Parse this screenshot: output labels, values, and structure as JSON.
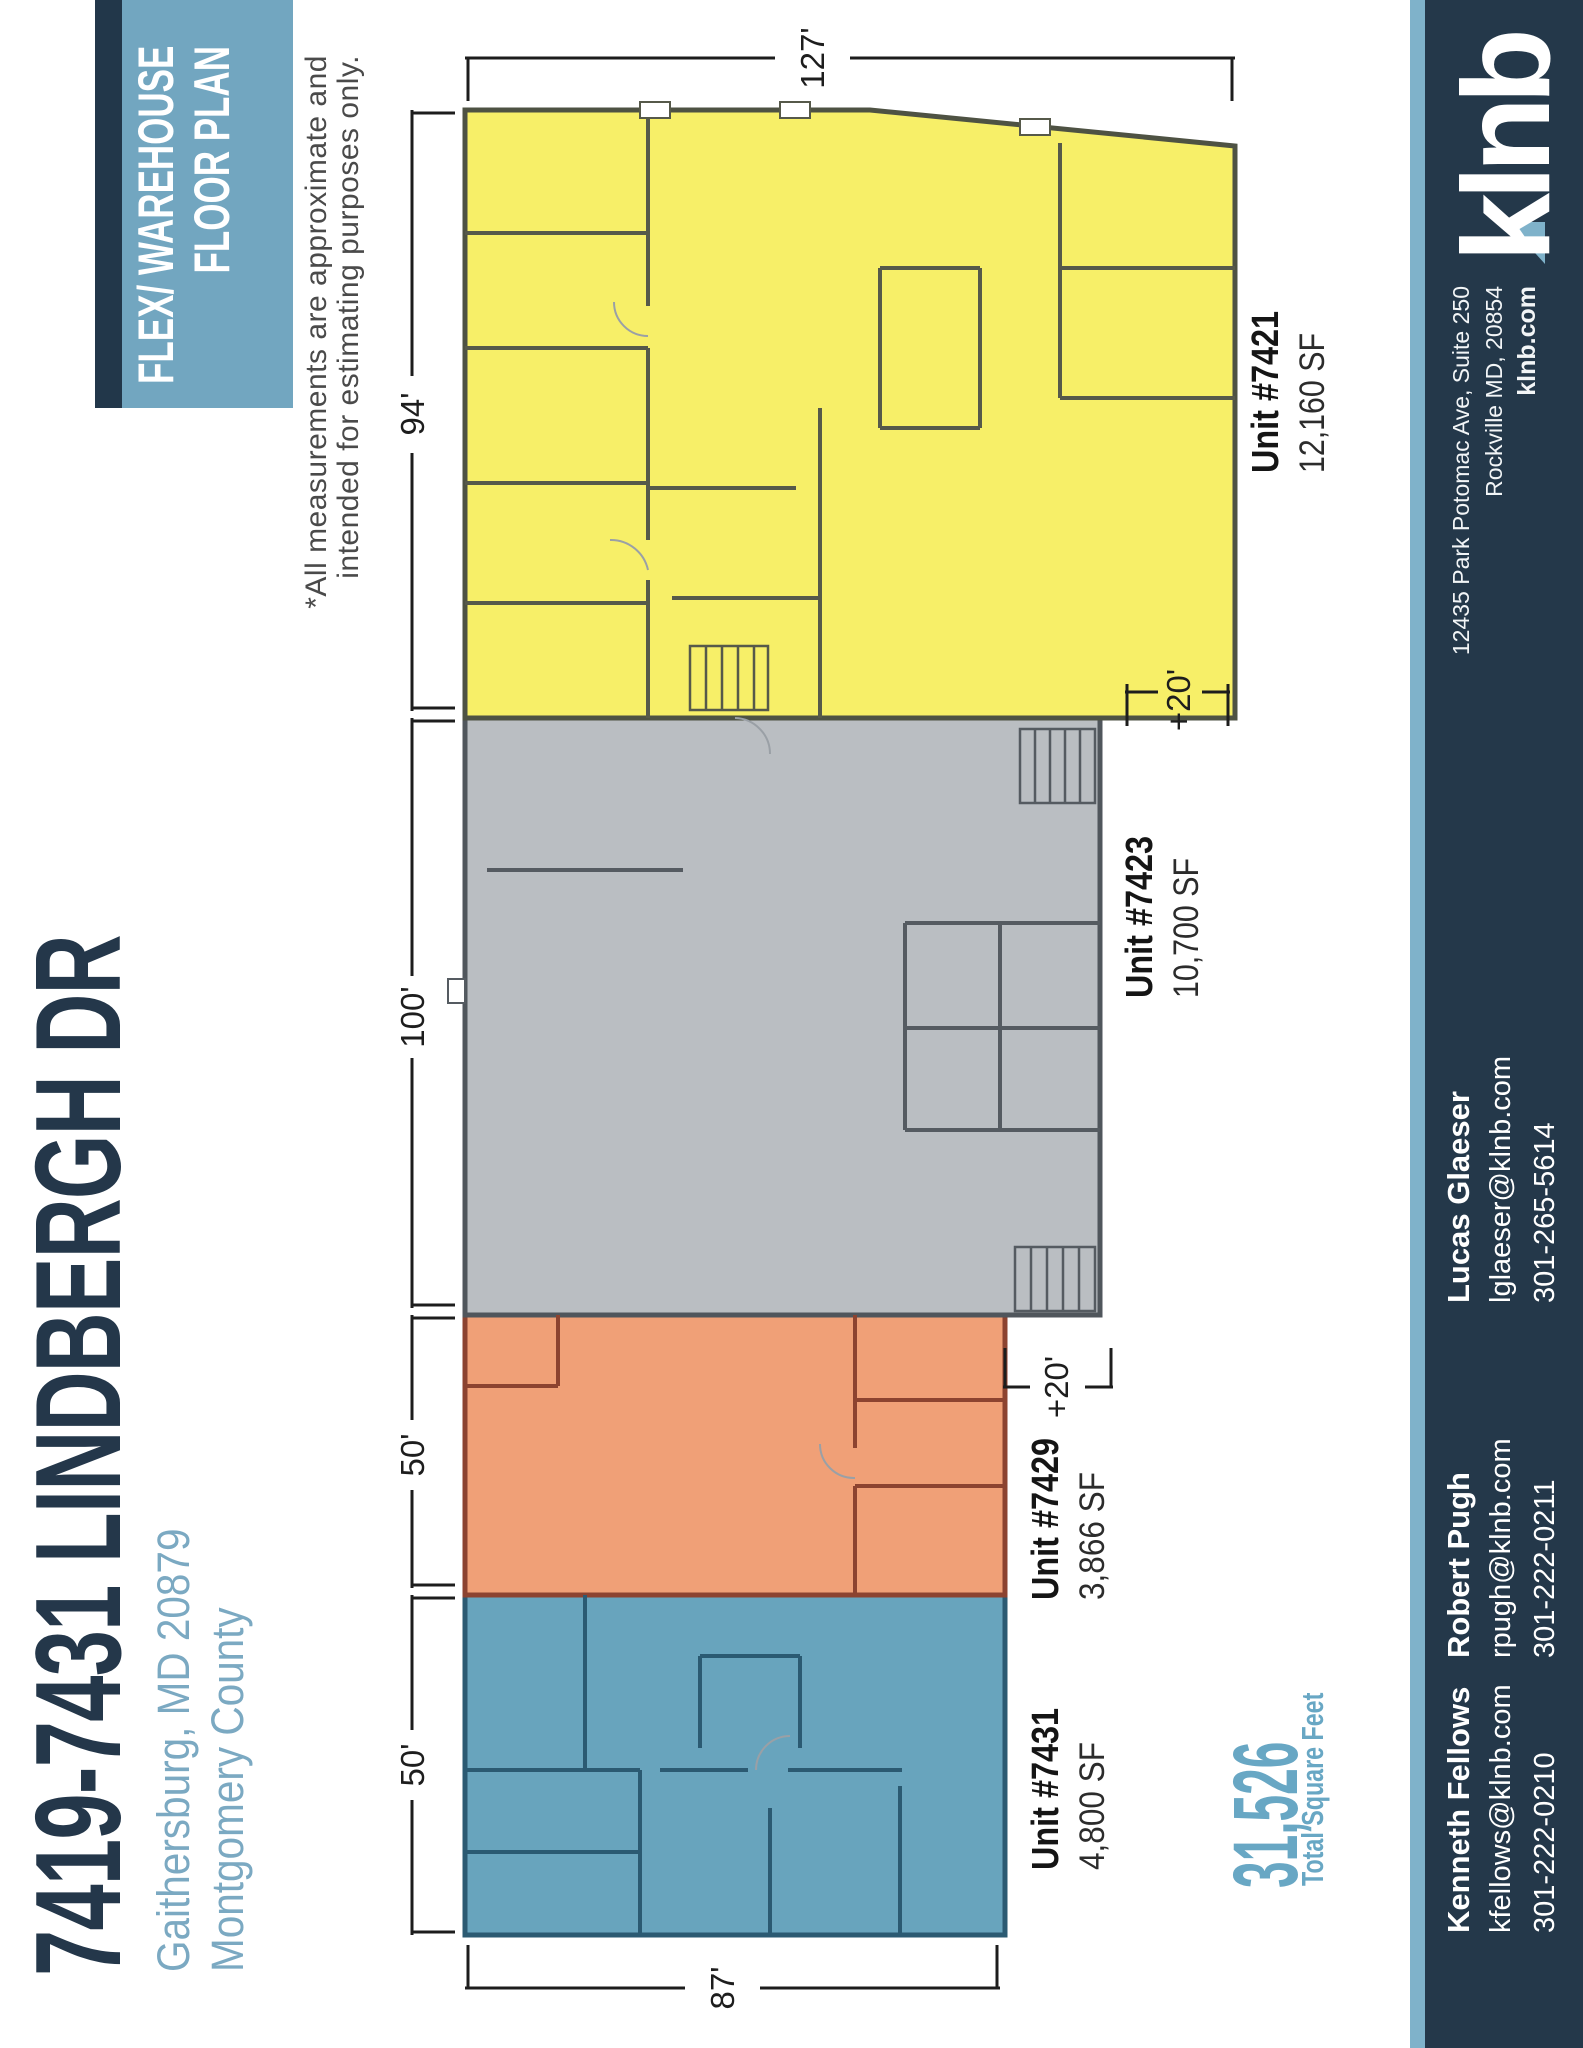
{
  "title": "7419-7431 LINDBERGH DR",
  "location": {
    "line1": "Gaithersburg, MD 20879",
    "line2": "Montgomery County"
  },
  "banner": {
    "line1": "FLEX/ WAREHOUSE",
    "line2": "FLOOR PLAN"
  },
  "disclaimer": {
    "line1": "*All measurements are approximate and",
    "line2": "intended for estimating purposes only."
  },
  "total": {
    "value": "31,526",
    "label": "Total Square Feet"
  },
  "units": [
    {
      "id": "7431",
      "name": "Unit #7431",
      "size": "4,800 SF",
      "color": "#68a4bd"
    },
    {
      "id": "7429",
      "name": "Unit #7429",
      "size": "3,866 SF",
      "color": "#f0a077"
    },
    {
      "id": "7423",
      "name": "Unit #7423",
      "size": "10,700 SF",
      "color": "#babec2"
    },
    {
      "id": "7421",
      "name": "Unit #7421",
      "size": "12,160 SF",
      "color": "#f7ef68"
    }
  ],
  "dimensions": {
    "top": [
      "50'",
      "50'",
      "100'",
      "94'"
    ],
    "left": "87'",
    "right": "127'",
    "ext1": "+20'",
    "ext2": "+20'"
  },
  "contacts": [
    {
      "name": "Kenneth Fellows",
      "email": "kfellows@klnb.com",
      "phone": "301-222-0210"
    },
    {
      "name": "Robert Pugh",
      "email": "rpugh@klnb.com",
      "phone": "301-222-0211"
    },
    {
      "name": "Lucas Glaeser",
      "email": "lglaeser@klnb.com",
      "phone": "301-265-5614"
    }
  ],
  "brand": {
    "logo": "klnb",
    "address1": "12435 Park Potomac Ave, Suite 250",
    "address2": "Rockville MD, 20854",
    "web": "klnb.com"
  },
  "colors": {
    "title_navy": "#24374a",
    "accent_blue": "#7ba9c2",
    "banner_blue": "#72a6c0",
    "footer_navy": "#24384a",
    "stripe_blue": "#7fb2ca",
    "total_teal": "#68a7c4",
    "unit_yellow": "#f7ef68",
    "unit_gray": "#babec2",
    "unit_orange": "#f0a077",
    "unit_blue": "#68a4bd"
  }
}
